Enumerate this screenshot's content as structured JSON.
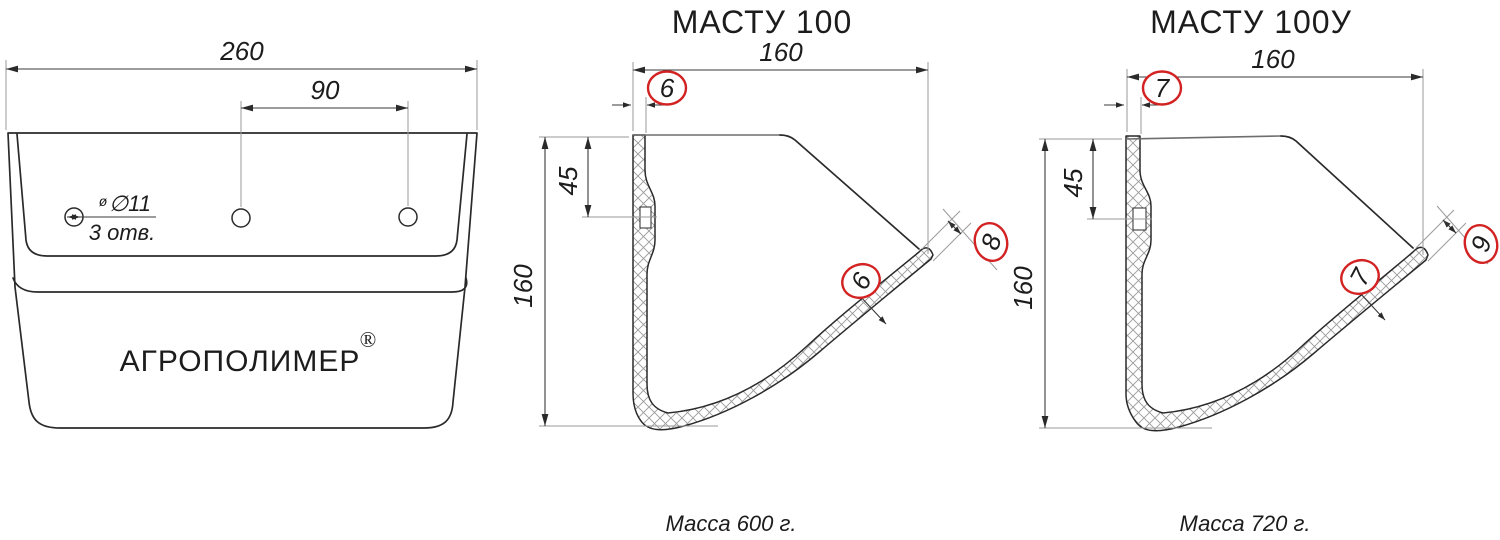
{
  "drawing": {
    "front_view": {
      "overall_width": "260",
      "hole_spacing": "90",
      "hole_diameter_prefix": "ø",
      "hole_diameter": "∅11",
      "hole_count": "3 отв.",
      "brand": "АГРОПОЛИМЕР",
      "registered_mark": "®"
    },
    "sections": [
      {
        "title": "МАСТУ 100",
        "width": "160",
        "height": "160",
        "hole_offset": "45",
        "top_wall": "6",
        "blade_wall": "6",
        "tip": "8",
        "mass": "Масса 600 г."
      },
      {
        "title": "МАСТУ 100У",
        "width": "160",
        "height": "160",
        "hole_offset": "45",
        "top_wall": "7",
        "blade_wall": "7",
        "tip": "9",
        "mass": "Масса 720 г."
      }
    ],
    "colors": {
      "line": "#2a2a2a",
      "thin_line": "#9a9a9a",
      "callout": "#d32222"
    }
  }
}
